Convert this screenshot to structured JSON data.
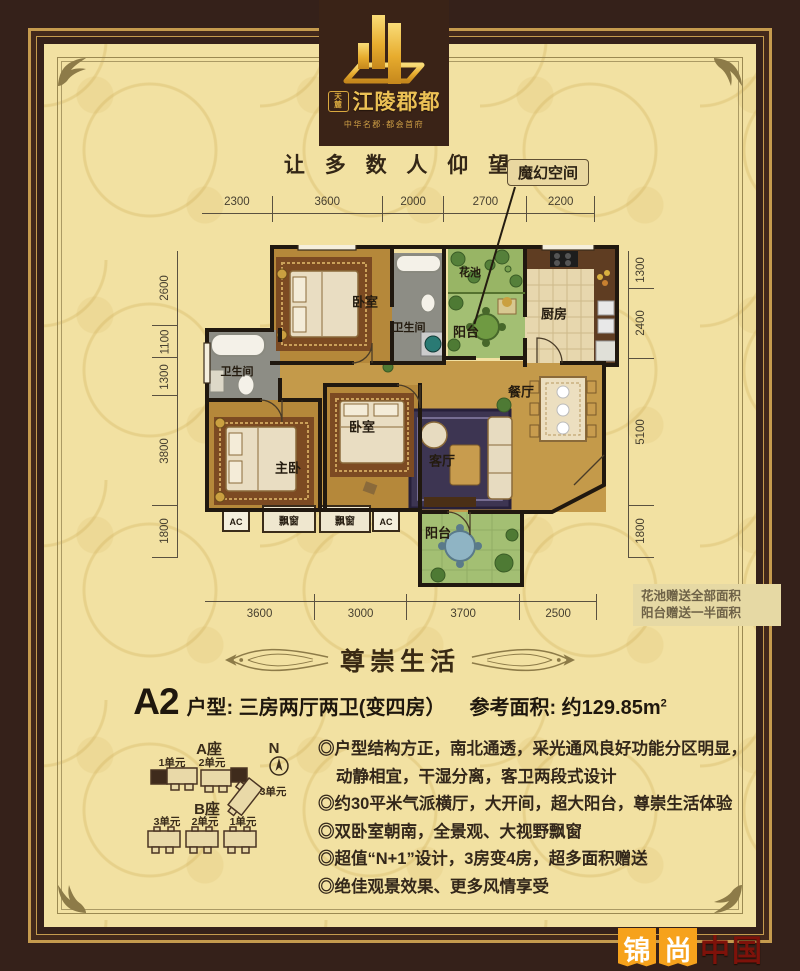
{
  "brand": {
    "seal_top": "天",
    "seal_bottom": "麓",
    "name": "江陵郡都",
    "subtitle": "中华名郡·都会首府"
  },
  "tagline": "让 多 数 人 仰 望",
  "callout": "魔幻空间",
  "plan": {
    "dims_top": [
      "2300",
      "3600",
      "2000",
      "2700",
      "2200"
    ],
    "dims_left": [
      "2600",
      "1100",
      "1300",
      "3800",
      "1800"
    ],
    "dims_right": [
      "1300",
      "2400",
      "5100",
      "1800"
    ],
    "dims_bottom": [
      "3600",
      "3000",
      "3700",
      "2500"
    ],
    "rooms": {
      "bedroom_top": "卧室",
      "bath_left": "卫生间",
      "bath_mid": "卫生间",
      "flower_pool": "花池",
      "balcony_top": "阳台",
      "kitchen": "厨房",
      "dining": "餐厅",
      "living": "客厅",
      "master": "主卧",
      "bedroom2": "卧室",
      "balcony_bottom": "阳台",
      "bay_window": "飘窗",
      "ac": "AC"
    },
    "note": [
      "花池赠送全部面积",
      "阳台赠送一半面积"
    ]
  },
  "section_banner": "尊崇生活",
  "unit": {
    "code": "A2",
    "desc": "户型: 三房两厅两卫(变四房）",
    "area": "参考面积: 约129.85m",
    "area_sup": "2"
  },
  "features": [
    "◎户型结构方正，南北通透，采光通风良好功能分区明显，动静相宜，干湿分离，客卫两段式设计",
    "◎约30平米气派横厅，大开间，超大阳台，尊崇生活体验",
    "◎双卧室朝南，全景观、大视野飘窗",
    "◎超值“N+1”设计，3房变4房，超多面积赠送",
    "◎绝佳观景效果、更多风情享受"
  ],
  "siteplan": {
    "block_a": "A座",
    "block_b": "B座",
    "a_units": [
      "1单元",
      "2单元",
      "3单元"
    ],
    "b_units": [
      "3单元",
      "2单元",
      "1单元"
    ],
    "compass": "N"
  },
  "watermark": {
    "w1": "锦",
    "w2": "尚",
    "w3": "中国"
  },
  "colors": {
    "frame_brown": "#35211a",
    "brand_gold": "#ecc155",
    "paper": "#f2e1a2",
    "wood_floor": "#c49a4a",
    "balcony_green": "#a3bf73",
    "watermark_orange": "#f6a21c"
  }
}
